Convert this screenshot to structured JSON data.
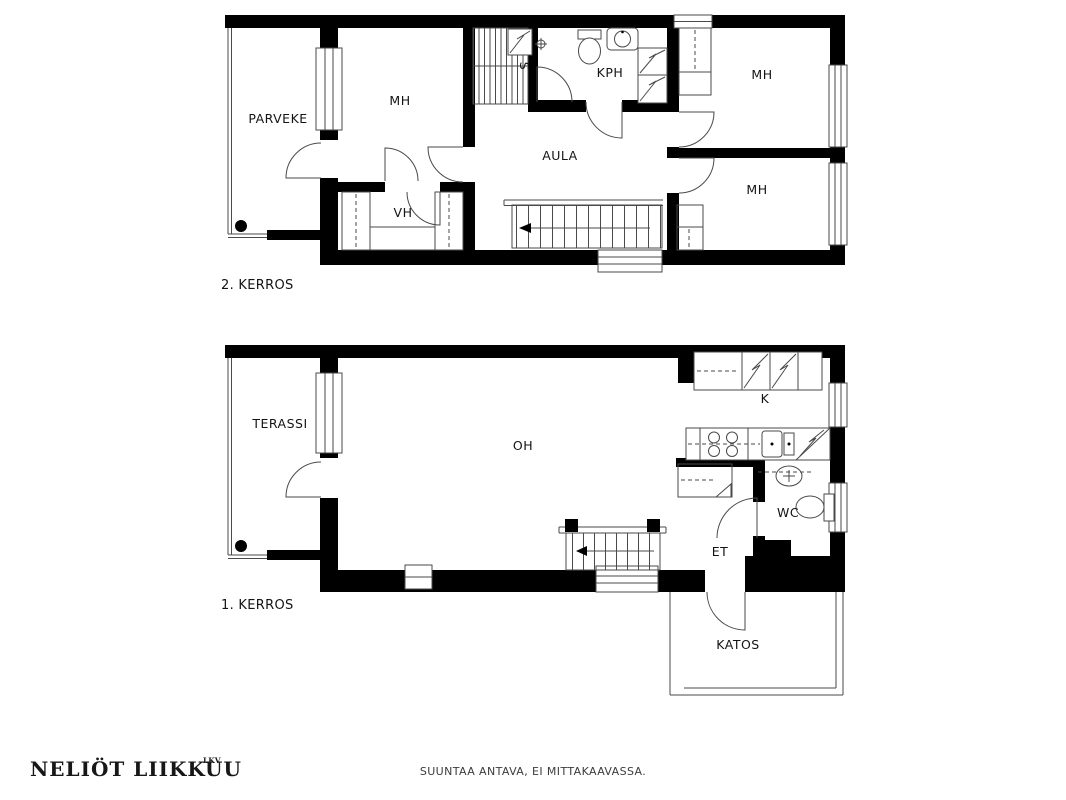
{
  "colors": {
    "background": "#ffffff",
    "wall": "#000000",
    "line": "#4a4a4a",
    "text": "#141414"
  },
  "floor2": {
    "label": "2. KERROS",
    "rooms": {
      "parveke": "PARVEKE",
      "mh_left": "MH",
      "sauna_s": "S",
      "kph": "KPH",
      "mh_top_right": "MH",
      "mh_bottom_right": "MH",
      "aula": "AULA",
      "vh": "VH"
    }
  },
  "floor1": {
    "label": "1. KERROS",
    "rooms": {
      "terassi": "TERASSI",
      "oh": "OH",
      "kitchen_k": "K",
      "wc": "WC",
      "et": "ET",
      "katos": "KATOS"
    }
  },
  "footer": {
    "brand": "NELIÖT LIIKKUU",
    "brand_suffix": "LKV",
    "disclaimer": "SUUNTAA ANTAVA, EI MITTAKAAVASSA."
  }
}
